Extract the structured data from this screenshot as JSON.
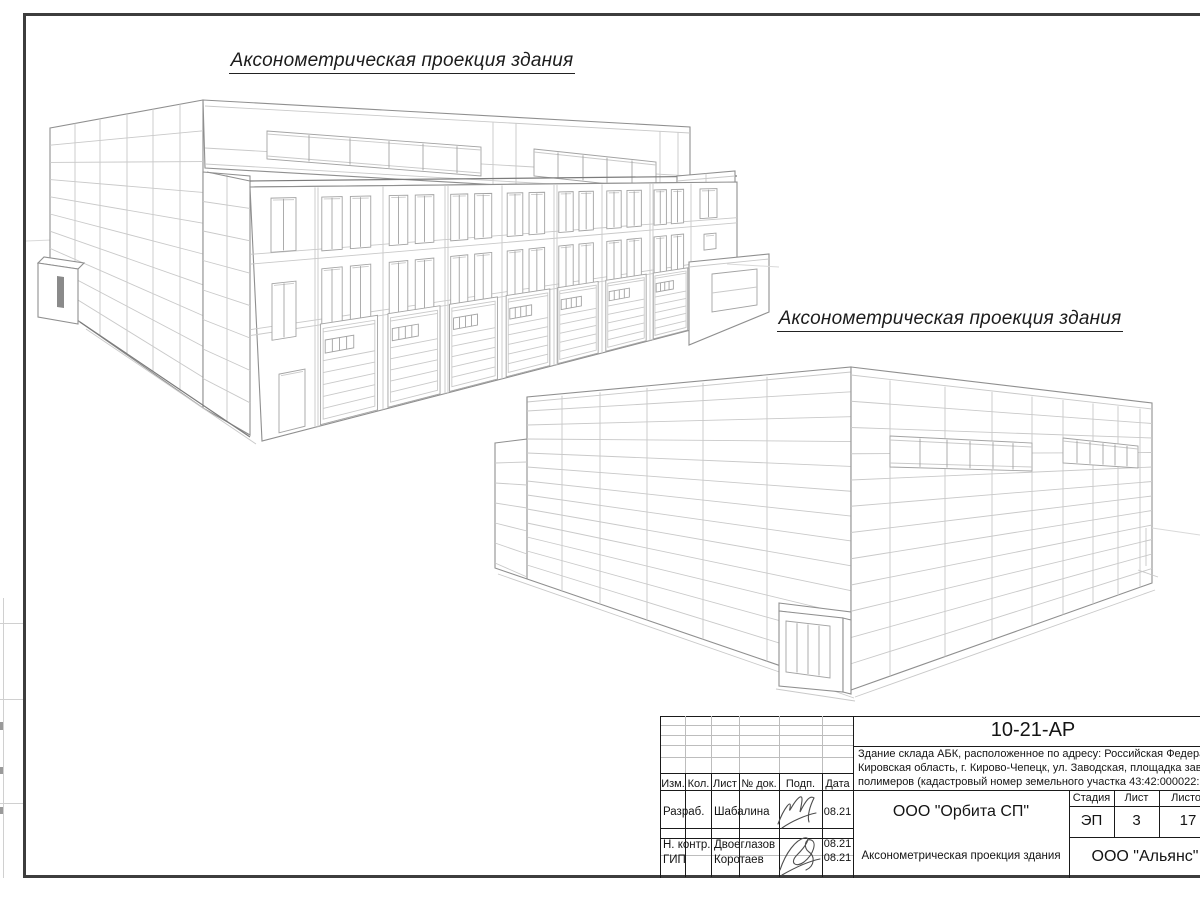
{
  "titles": {
    "view1": "Аксонометрическая проекция здания",
    "view2": "Аксонометрическая проекция здания"
  },
  "title_block": {
    "doc_number": "10-21-АР",
    "desc": [
      "Здание склада АБК, расположенное по адресу: Российская Федерация,",
      "Кировская область, г. Кирово-Чепецк, ул. Заводская, площадка завода",
      "полимеров (кадастровый номер земельного участка 43:42:000022:33"
    ],
    "cols": {
      "izm": "Изм.",
      "kol": "Кол.",
      "list": "Лист",
      "doc": "№ док.",
      "podp": "Подп.",
      "data": "Дата"
    },
    "rows": [
      {
        "role": "Разраб.",
        "name": "Шабалина",
        "date": "08.21"
      },
      {
        "role": "Н. контр.",
        "name": "Двоеглазов",
        "date": "08.21"
      },
      {
        "role": "ГИП",
        "name": "Коротаев",
        "date": "08.21"
      }
    ],
    "org": "ООО \"Орбита СП\"",
    "stage_label": "Стадия",
    "sheet_label": "Лист",
    "sheets_label": "Листов",
    "stage": "ЭП",
    "sheet": "3",
    "sheets": "17",
    "sheet_title": "Аксонометрическая проекция здания",
    "contractor": "ООО \"Альянс\""
  },
  "colors": {
    "frame": "#3d3d3d",
    "edge_line": "#8f8f8f",
    "panel_line": "#c9c9c9",
    "text": "#141414"
  }
}
